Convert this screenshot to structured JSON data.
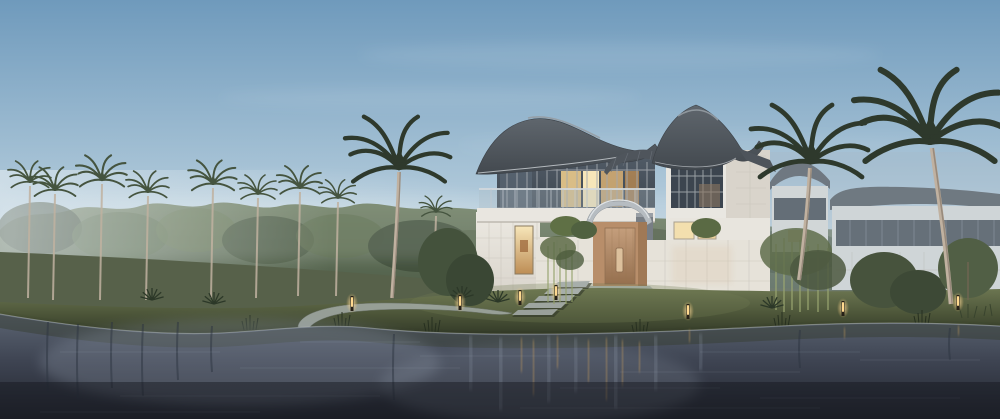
{
  "scene_type": "lakeside-villa-architectural-rendering",
  "time_of_day": "dusk",
  "palette": {
    "sky_top": "#6f9abc",
    "sky_mid": "#9fbdd2",
    "sky_low": "#cfdfe8",
    "sky_horizon": "#e6ecef",
    "tree_dark": "#42503f",
    "tree_mid": "#5a6a52",
    "tree_light": "#7e8e6c",
    "palm_frond_bg": "#45543f",
    "palm_frond_fg": "#2e392c",
    "palm_trunk": "#c0b1a0",
    "roof_dark": "#43494f",
    "roof_mid": "#5f666d",
    "roof_highlight": "#969da4",
    "roof_edge": "#ced3d7",
    "wall_white": "#ece9e2",
    "wall_shade": "#d8d3ca",
    "panel_joint": "#c6c1b7",
    "glass_dark": "#3d4650",
    "glass_sky": "#6e7e8b",
    "mullion": "#a3a8ad",
    "window_glow_bright": "#f7e6b9",
    "window_glow": "#e9c98b",
    "window_glow_deep": "#bd8d55",
    "door_wood": "#b88e6a",
    "door_wood_dark": "#96704f",
    "canopy_metal": "#b6bcc1",
    "grass_light": "#6d7752",
    "grass_mid": "#4d5639",
    "grass_dark": "#333a28",
    "path_stone": "#9da59e",
    "step_stone": "#a7aeaa",
    "water_top": "#5c6573",
    "water_mid": "#3e4452",
    "water_deep": "#22252e",
    "reflection_pale": "#9aa4b4",
    "light_amber": "#d9a85f",
    "bollard_core": "#ffd98f",
    "neighbor_wall": "#e0e1de",
    "neighbor_roof": "#565c63",
    "neighbor_window": "#495058",
    "haze": "#a9bac8"
  },
  "lighting": {
    "bollards": [
      {
        "x": 352,
        "y": 296
      },
      {
        "x": 460,
        "y": 295
      },
      {
        "x": 520,
        "y": 290
      },
      {
        "x": 556,
        "y": 285
      },
      {
        "x": 688,
        "y": 304
      },
      {
        "x": 843,
        "y": 301
      },
      {
        "x": 958,
        "y": 295
      }
    ]
  },
  "vegetation": {
    "background_palms": [
      {
        "x": 30,
        "crown_y": 182,
        "base_y": 298,
        "scale": 0.55
      },
      {
        "x": 55,
        "crown_y": 190,
        "base_y": 300,
        "scale": 0.6
      },
      {
        "x": 102,
        "crown_y": 180,
        "base_y": 300,
        "scale": 0.65
      },
      {
        "x": 148,
        "crown_y": 192,
        "base_y": 300,
        "scale": 0.55
      },
      {
        "x": 213,
        "crown_y": 184,
        "base_y": 298,
        "scale": 0.62
      },
      {
        "x": 258,
        "crown_y": 194,
        "base_y": 298,
        "scale": 0.5
      },
      {
        "x": 300,
        "crown_y": 188,
        "base_y": 296,
        "scale": 0.58
      },
      {
        "x": 338,
        "crown_y": 198,
        "base_y": 296,
        "scale": 0.48
      },
      {
        "x": 436,
        "crown_y": 212,
        "base_y": 282,
        "scale": 0.42
      }
    ],
    "foreground_palms": [
      {
        "x": 399,
        "crown_y": 168,
        "scale": 1.35,
        "trunk": "M399,172 C398,212 395,252 392,298",
        "trunk_w": 3.6
      },
      {
        "x": 811,
        "crown_y": 162,
        "scale": 1.5,
        "trunk": "M810,168 C808,205 804,244 799,280",
        "trunk_w": 4
      },
      {
        "x": 930,
        "crown_y": 142,
        "scale": 1.9,
        "trunk": "M932,148 C938,192 946,244 951,304",
        "trunk_w": 4.6
      }
    ],
    "palmettos": [
      {
        "x": 152,
        "y": 300
      },
      {
        "x": 214,
        "y": 304
      },
      {
        "x": 462,
        "y": 298
      },
      {
        "x": 498,
        "y": 302
      },
      {
        "x": 772,
        "y": 308
      }
    ],
    "reeds": [
      {
        "x": 250,
        "y": 330
      },
      {
        "x": 342,
        "y": 327
      },
      {
        "x": 432,
        "y": 332
      },
      {
        "x": 640,
        "y": 334
      },
      {
        "x": 782,
        "y": 327
      },
      {
        "x": 922,
        "y": 325
      }
    ]
  },
  "water": {
    "warm_streaks": [
      {
        "x": 521,
        "y1": 338,
        "y2": 372
      },
      {
        "x": 533,
        "y1": 340,
        "y2": 395
      },
      {
        "x": 557,
        "y1": 336,
        "y2": 368
      },
      {
        "x": 588,
        "y1": 340,
        "y2": 382
      },
      {
        "x": 606,
        "y1": 338,
        "y2": 400
      },
      {
        "x": 622,
        "y1": 340,
        "y2": 386
      },
      {
        "x": 639,
        "y1": 342,
        "y2": 372
      },
      {
        "x": 689,
        "y1": 330,
        "y2": 342
      },
      {
        "x": 844,
        "y1": 328,
        "y2": 338
      },
      {
        "x": 958,
        "y1": 326,
        "y2": 335
      }
    ],
    "pale_streaks": [
      {
        "x": 470,
        "y1": 336,
        "y2": 390,
        "w": 5
      },
      {
        "x": 500,
        "y1": 338,
        "y2": 410,
        "w": 7
      },
      {
        "x": 548,
        "y1": 336,
        "y2": 402,
        "w": 6
      },
      {
        "x": 575,
        "y1": 338,
        "y2": 392,
        "w": 5
      },
      {
        "x": 615,
        "y1": 336,
        "y2": 408,
        "w": 8
      },
      {
        "x": 655,
        "y1": 336,
        "y2": 390,
        "w": 6
      },
      {
        "x": 700,
        "y1": 334,
        "y2": 370,
        "w": 5
      }
    ],
    "trunk_streaks": [
      {
        "x": 48,
        "y1": 322,
        "y2": 392
      },
      {
        "x": 78,
        "y1": 324,
        "y2": 398
      },
      {
        "x": 112,
        "y1": 322,
        "y2": 388
      },
      {
        "x": 143,
        "y1": 324,
        "y2": 396
      },
      {
        "x": 178,
        "y1": 322,
        "y2": 380
      },
      {
        "x": 212,
        "y1": 326,
        "y2": 372
      },
      {
        "x": 394,
        "y1": 334,
        "y2": 400
      },
      {
        "x": 800,
        "y1": 330,
        "y2": 368
      },
      {
        "x": 950,
        "y1": 328,
        "y2": 360
      }
    ],
    "ripples": [
      {
        "x": 60,
        "y": 352,
        "len": 160
      },
      {
        "x": 240,
        "y": 368,
        "len": 220
      },
      {
        "x": 120,
        "y": 396,
        "len": 260
      },
      {
        "x": 420,
        "y": 356,
        "len": 140
      },
      {
        "x": 520,
        "y": 408,
        "len": 300
      },
      {
        "x": 620,
        "y": 372,
        "len": 180
      },
      {
        "x": 300,
        "y": 342,
        "len": 120
      },
      {
        "x": 700,
        "y": 352,
        "len": 160
      },
      {
        "x": 760,
        "y": 398,
        "len": 200
      },
      {
        "x": 40,
        "y": 412,
        "len": 220
      },
      {
        "x": 860,
        "y": 360,
        "len": 120
      },
      {
        "x": 560,
        "y": 388,
        "len": 160
      }
    ]
  }
}
